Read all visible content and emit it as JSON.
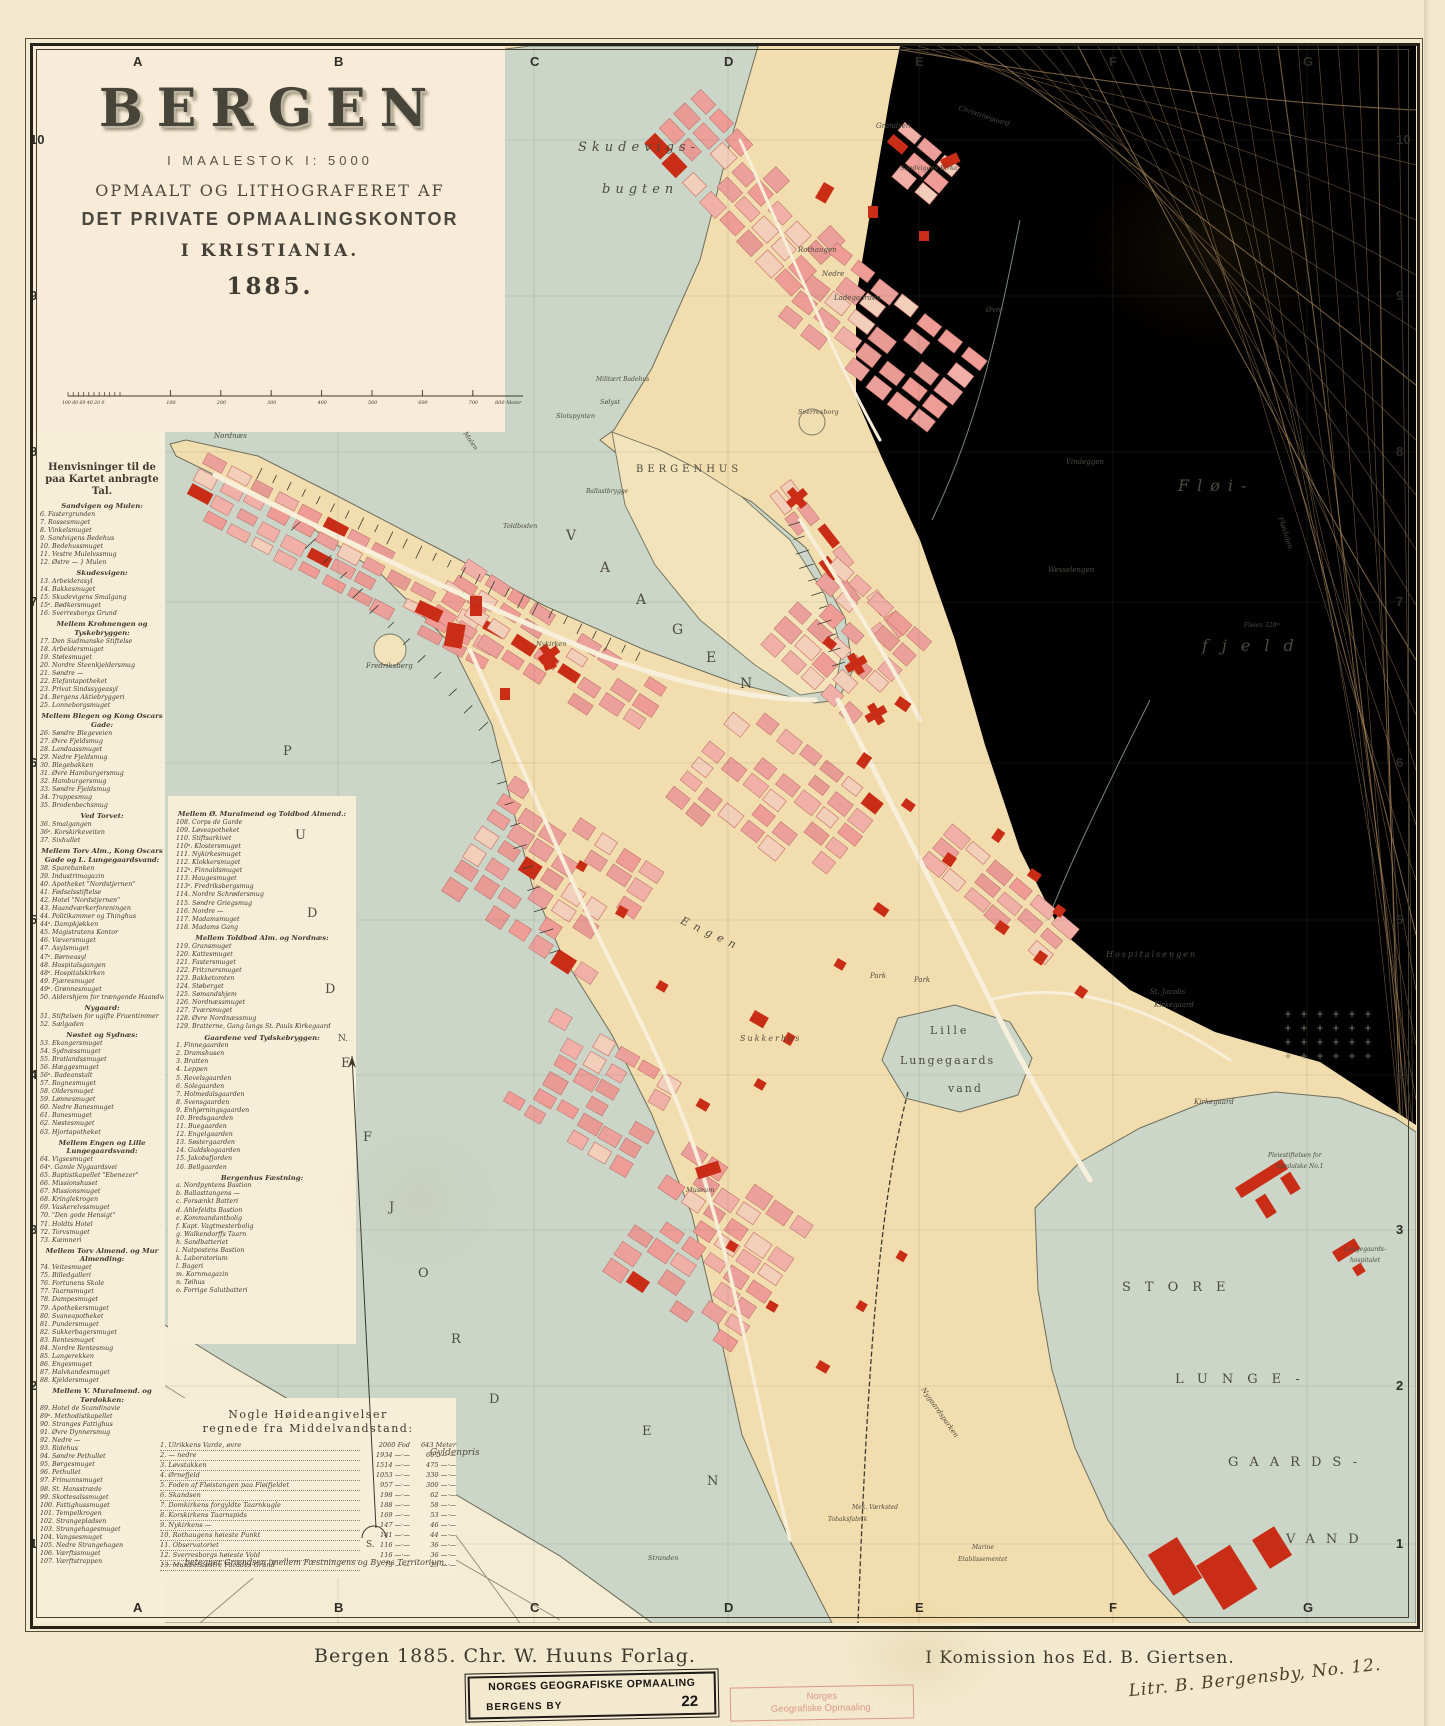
{
  "title": {
    "main": "BERGEN",
    "scale_line": "I MAALESTOK  I: 5000",
    "line2": "OPMAALT OG LITHOGRAFERET AF",
    "line3": "DET PRIVATE OPMAALINGSKONTOR",
    "line4": "I KRISTIANIA.",
    "year": "1885."
  },
  "scale_bar": {
    "sub_labels": "100 80 60 40 20 0",
    "ticks": [
      "100",
      "200",
      "300",
      "400",
      "500",
      "600",
      "700"
    ],
    "end_label": "800 Meter"
  },
  "grid": {
    "columns": [
      "A",
      "B",
      "C",
      "D",
      "E",
      "F",
      "G"
    ],
    "rows": [
      "10",
      "9",
      "8",
      "7",
      "6",
      "5",
      "4",
      "3",
      "2",
      "1"
    ]
  },
  "legend": {
    "title": "Henvisninger til de paa Kartet anbragte Tal.",
    "left_sections": [
      {
        "head": "Sandvigen og Mulen:",
        "items": [
          "6. Fastergrunden",
          "7. Rossesmuget",
          "8. Vinkelsmuget",
          "9. Sandvigens Bedehus",
          "10. Bedehussmuget",
          "11. Vestre Mulelvssmug",
          "12. Østre —  } Mulen"
        ]
      },
      {
        "head": "Skudesvigen:",
        "items": [
          "13. Arbeiderasyl",
          "14. Bakkesmuget",
          "15. Skudevigens Smalgang",
          "15ᵃ. Bødkersmuget",
          "16. Sverresborgs Grund"
        ]
      },
      {
        "head": "Mellem Krohnengen og Tyskebryggen:",
        "items": [
          "17. Den Sudmanske Stiftelse",
          "18. Arbeidersmuget",
          "19. Stølesmuget",
          "20. Nordre Steenkjeldersmug",
          "21. Søndre —",
          "22. Elefantapotheket",
          "23. Privat Sindssygeasyl",
          "24. Bergens Aktiebryggeri",
          "25. Lonneborgsmuget"
        ]
      },
      {
        "head": "Mellem Blegen og Kong Oscars Gade:",
        "items": [
          "26. Søndre Blegeveien",
          "27. Øvre Fjeldsmug",
          "28. Landaassmuget",
          "29. Nedre Fjeldsmug",
          "30. Blegebakken",
          "31. Øvre Hamburgersmug",
          "32. Hamburgersmug",
          "33. Søndre Fjeldsmug",
          "34. Trappesmug",
          "35. Brodenbechsmug"
        ]
      },
      {
        "head": "Ved Torvet:",
        "items": [
          "36. Smalgangen",
          "36ᵃ. Korskirkeveiten",
          "37. Sixhullet"
        ]
      },
      {
        "head": "Mellem Torv Alm., Kong Oscars Gade og L. Lungegaardsvand:",
        "items": [
          "38. Sparebanken",
          "39. Industrimagazin",
          "40. Apotheket \"Nordstjernen\"",
          "41. Fødselsstiftelse",
          "42. Hotel \"Nordstjernen\"",
          "43. Haandværkerforeningen",
          "44. Politikammer og Thinghus",
          "44ᵃ. Dampkjøkken",
          "45. Magistratens Kontor",
          "46. Væversmuget",
          "47. Asylsmuget",
          "47ᵃ. Børneasyl",
          "48. Hospitalsgangen",
          "48ᵃ. Hospitalskirken",
          "49. Fjæresmuget",
          "49ᵃ. Grønnesmuget",
          "50. Aldershjem for trængende Haandværkere"
        ]
      },
      {
        "head": "Nygaard:",
        "items": [
          "51. Stiftelsen for ugifte Fruentimmer",
          "52. Sælgaden"
        ]
      },
      {
        "head": "Nøstet og Sydnæs:",
        "items": [
          "53. Ekangersmuget",
          "54. Sydnæssmuget",
          "55. Bratlandssmuget",
          "56. Hæggesmuget",
          "56ᵃ. Badeanstalt",
          "57. Rognesmuget",
          "58. Oldersmuget",
          "59. Lønnesmuget",
          "60. Nedre Banesmuget",
          "61. Banesmuget",
          "62. Nøstesmuget",
          "63. Hjortapotheket"
        ]
      },
      {
        "head": "Mellem Engen og Lille Lungegaardsvand:",
        "items": [
          "64. Vigsesmuget",
          "64ᵃ. Gamle Nygaardsvei",
          "65. Baptistkapellet \"Ebenezer\"",
          "66. Missionshuset",
          "67. Missionsmuget",
          "68. Kringlekrogen",
          "69. Vaskerelvssmuget",
          "70. \"Den gode Hensigt\"",
          "71. Holdts Hotel",
          "72. Torvsmuget",
          "73. Kæmneri"
        ]
      },
      {
        "head": "Mellem Torv Almend. og Mur Almending:",
        "items": [
          "74. Veitesmuget",
          "75. Billedgalleri",
          "76. Fortunens Skole",
          "77. Taarnsmuget",
          "78. Dampesmuget",
          "79. Apothekersmuget",
          "80. Svaneapotheket",
          "81. Pundersmuget",
          "82. Sukkerbagersmuget",
          "83. Rentesmuget",
          "84. Nordre Rentesmug",
          "85. Langerekken",
          "86. Engesmuget",
          "87. Halvkandesmuget",
          "88. Kjeldersmuget"
        ]
      },
      {
        "head": "Mellem V. Muralmend. og Tørdokken:",
        "items": [
          "89. Hotel de Scandinavie",
          "89ᵃ. Methodistkapellet",
          "90. Stranges Fattighus",
          "91. Øvre Dynnersmug",
          "92. Nedre —",
          "93. Ridehus",
          "94. Søndre Pethullet",
          "95. Børgesmuget",
          "96. Pethullet",
          "97. Frimannsmuget",
          "98. St. Hansstræde",
          "99. Skottesalssmuget",
          "100. Fattighussmuget",
          "101. Tempelkrogen",
          "102. Strangepladsen",
          "103. Strangehagesmuget",
          "104. Vangsesmuget",
          "105. Nedre Strangehagen",
          "106. Værftssmuget",
          "107. Værftstrappen"
        ]
      }
    ],
    "mid_sections": [
      {
        "head": "Mellem Ø. Muralmend og Toldbod Almend.:",
        "items": [
          "108. Corps de Garde",
          "109. Løveapotheket",
          "110. Stiftsarkivet",
          "110ᵃ. Klostersmuget",
          "111. Nykirkesmuget",
          "112. Klokkersmuget",
          "112ᵃ. Finnaldsmuget",
          "113. Haugesmuget",
          "113ᵃ. Fredriksbergsmug",
          "114. Nordre Schrødersmug",
          "115. Søndre Griegsmug",
          "116. Nordre —",
          "117. Madamsmuget",
          "118. Madams Gang"
        ]
      },
      {
        "head": "Mellem Toldbod Alm. og Nordnæs:",
        "items": [
          "119. Gransmuget",
          "120. Kattesmuget",
          "121. Fastersmuget",
          "122. Fritznersmuget",
          "123. Bakketomten",
          "124. Støberget",
          "125. Sømandshjem",
          "126. Nordnæssmuget",
          "127. Tværsmuget",
          "128. Øvre Nordnæssmug",
          "129. Bratterne, Gang langs St. Pauls Kirkegaard"
        ]
      },
      {
        "head": "Gaardene ved Tydskebryggen:",
        "items": [
          "1. Finnegaarden",
          "2. Dramshusen",
          "3. Bratten",
          "4. Leppen",
          "5. Revelsgaarden",
          "6. Solegaarden",
          "7. Holmedalsgaarden",
          "8. Svensgaarden",
          "9. Enhjørningsgaarden",
          "10. Bredsgaarden",
          "11. Buegaarden",
          "12. Engelgaarden",
          "13. Søstergaarden",
          "14. Guldskogaarden",
          "15. Jakobsfjorden",
          "16. Bellgaarden"
        ]
      },
      {
        "head": "Bergenhus Fæstning:",
        "items": [
          "a. Nordpyntens Bastion",
          "b. Ballasttangens —",
          "c. Forsænkt Batteri",
          "d. Ahlefeldts Bastion",
          "e. Kommandantbolig",
          "f. Kapt. Vagtmesterbolig",
          "g. Walkendorffs Taarn",
          "h. Sandbatteriet",
          "i. Natpostens Bastion",
          "k. Laboratorium",
          "l. Bageri",
          "m. Kornmagazin",
          "n. Tøihus",
          "o. Forrige Salutbatteri"
        ]
      }
    ]
  },
  "heights": {
    "title1": "Nogle Høideangivelser",
    "title2": "regnede fra Middelvandstand:",
    "fod_unit": "Fod",
    "meter_unit": "Meter",
    "rows": [
      {
        "n": "1.",
        "name": "Ulrikkens Varde, øvre",
        "fod": "2060",
        "meter": "643"
      },
      {
        "n": "2.",
        "name": "—  nedre",
        "fod": "1934",
        "meter": "607"
      },
      {
        "n": "3.",
        "name": "Løvstakken",
        "fod": "1514",
        "meter": "475"
      },
      {
        "n": "4.",
        "name": "Ørnefjeld",
        "fod": "1053",
        "meter": "330"
      },
      {
        "n": "5.",
        "name": "Foden af Fløistangen paa Fløifjeldet",
        "fod": "957",
        "meter": "300"
      },
      {
        "n": "6.",
        "name": "Skandsen",
        "fod": "198",
        "meter": "62"
      },
      {
        "n": "7.",
        "name": "Domkirkens forgyldte Taarnkugle",
        "fod": "188",
        "meter": "58"
      },
      {
        "n": "8.",
        "name": "Korskirkens Taarnspids",
        "fod": "169",
        "meter": "53"
      },
      {
        "n": "9.",
        "name": "Nykirkens —",
        "fod": "147",
        "meter": "46"
      },
      {
        "n": "10.",
        "name": "Rothaugens høieste Punkt",
        "fod": "141",
        "meter": "44"
      },
      {
        "n": "11.",
        "name": "Observatoriet",
        "fod": "116",
        "meter": "36"
      },
      {
        "n": "12.",
        "name": "Sverresborgs høieste Vold",
        "fod": "116",
        "meter": "36"
      },
      {
        "n": "13.",
        "name": "Musæets østre Facades Grund",
        "fod": "73",
        "meter": "23"
      }
    ]
  },
  "boundary_note": "........  betegner Grændsen imellem Fæstningens og Byens Territorium.",
  "footer": {
    "left": "Bergen 1885.  Chr. W. Huuns  Forlag.",
    "right": "I Komission hos Ed. B. Giertsen.",
    "stamp_black_line1": "NORGES GEOGRAFISKE OPMAALING",
    "stamp_black_line2": "BERGENS BY",
    "stamp_black_number": "22",
    "stamp_red_line1": "Norges",
    "stamp_red_line2": "Geografiske Opmaaling.",
    "signature": "Litr. B. Bergensby, No. 12."
  },
  "colors": {
    "paper": "#f3e9ce",
    "water": "#cbd6c8",
    "land": "#f2ddae",
    "mountain": "#eed19e",
    "block_pink": "#eba09b",
    "building_red": "#c92d16",
    "contour": "#bb9464"
  },
  "labels": [
    {
      "t": "Skudevigs-",
      "x": 578,
      "y": 140,
      "s": 13,
      "l": 5,
      "i": 1
    },
    {
      "t": "bugten",
      "x": 602,
      "y": 182,
      "s": 13,
      "l": 5,
      "i": 1
    },
    {
      "t": "V",
      "x": 566,
      "y": 528,
      "s": 14
    },
    {
      "t": "A",
      "x": 600,
      "y": 560,
      "s": 14
    },
    {
      "t": "A",
      "x": 636,
      "y": 592,
      "s": 14
    },
    {
      "t": "G",
      "x": 672,
      "y": 622,
      "s": 14
    },
    {
      "t": "E",
      "x": 706,
      "y": 650,
      "s": 14
    },
    {
      "t": "N",
      "x": 740,
      "y": 676,
      "s": 14
    },
    {
      "t": "P",
      "x": 283,
      "y": 744,
      "s": 13
    },
    {
      "t": "U",
      "x": 295,
      "y": 828,
      "s": 13
    },
    {
      "t": "D",
      "x": 307,
      "y": 906,
      "s": 13
    },
    {
      "t": "D",
      "x": 325,
      "y": 982,
      "s": 13
    },
    {
      "t": "E",
      "x": 341,
      "y": 1056,
      "s": 13
    },
    {
      "t": "F",
      "x": 363,
      "y": 1130,
      "s": 13
    },
    {
      "t": "J",
      "x": 389,
      "y": 1200,
      "s": 13
    },
    {
      "t": "O",
      "x": 418,
      "y": 1266,
      "s": 13
    },
    {
      "t": "R",
      "x": 451,
      "y": 1332,
      "s": 13
    },
    {
      "t": "D",
      "x": 489,
      "y": 1392,
      "s": 13
    },
    {
      "t": "E",
      "x": 642,
      "y": 1424,
      "s": 13
    },
    {
      "t": "N",
      "x": 707,
      "y": 1474,
      "s": 13
    },
    {
      "t": "STORE",
      "x": 1122,
      "y": 1280,
      "s": 13,
      "l": 14
    },
    {
      "t": "LUNGE-",
      "x": 1175,
      "y": 1372,
      "s": 13,
      "l": 14
    },
    {
      "t": "GAARDS-",
      "x": 1228,
      "y": 1455,
      "s": 13,
      "l": 11
    },
    {
      "t": "VAND",
      "x": 1286,
      "y": 1532,
      "s": 13,
      "l": 11
    },
    {
      "t": "Lille",
      "x": 930,
      "y": 1024,
      "s": 11,
      "l": 3
    },
    {
      "t": "Lungegaards",
      "x": 900,
      "y": 1054,
      "s": 11,
      "l": 2
    },
    {
      "t": "vand",
      "x": 948,
      "y": 1082,
      "s": 11,
      "l": 2
    },
    {
      "t": "BERGENHUS",
      "x": 636,
      "y": 464,
      "s": 10,
      "l": 4
    },
    {
      "t": "Fløi-",
      "x": 1178,
      "y": 476,
      "s": 16,
      "l": 8,
      "i": 1
    },
    {
      "t": "fjeld",
      "x": 1202,
      "y": 636,
      "s": 16,
      "l": 14,
      "i": 1
    },
    {
      "t": "Fløidalen",
      "x": 1284,
      "y": 516,
      "s": 7,
      "i": 1,
      "r": 72
    },
    {
      "t": "Fløien 320ᵐ",
      "x": 1244,
      "y": 622,
      "s": 6,
      "i": 1
    },
    {
      "t": "Vindeggen",
      "x": 1066,
      "y": 458,
      "s": 7,
      "i": 1
    },
    {
      "t": "Wesselengen",
      "x": 1048,
      "y": 566,
      "s": 7,
      "i": 1
    },
    {
      "t": "Rothaugen",
      "x": 798,
      "y": 246,
      "s": 7,
      "i": 1
    },
    {
      "t": "Nedre",
      "x": 822,
      "y": 270,
      "s": 7,
      "i": 1
    },
    {
      "t": "Ladegaarden",
      "x": 834,
      "y": 294,
      "s": 7,
      "i": 1
    },
    {
      "t": "Øvre",
      "x": 986,
      "y": 306,
      "s": 7,
      "i": 1
    },
    {
      "t": "Grandsen",
      "x": 876,
      "y": 122,
      "s": 7,
      "i": 1
    },
    {
      "t": "Christinegaard",
      "x": 960,
      "y": 104,
      "s": 7,
      "i": 1,
      "r": 18
    },
    {
      "t": "Sandvigens Kirke",
      "x": 900,
      "y": 164,
      "s": 6.5,
      "i": 1
    },
    {
      "t": "Sverresborg",
      "x": 798,
      "y": 408,
      "s": 6.5,
      "i": 1
    },
    {
      "t": "Slotspynten",
      "x": 556,
      "y": 412,
      "s": 6.5,
      "i": 1
    },
    {
      "t": "Sølyst",
      "x": 600,
      "y": 398,
      "s": 6.5,
      "i": 1
    },
    {
      "t": "Militært Badehus",
      "x": 596,
      "y": 376,
      "s": 6,
      "i": 1
    },
    {
      "t": "Ballastbrygge",
      "x": 586,
      "y": 488,
      "s": 6,
      "i": 1
    },
    {
      "t": "Molen",
      "x": 468,
      "y": 430,
      "s": 6.5,
      "i": 1,
      "r": 55
    },
    {
      "t": "Toldboden",
      "x": 503,
      "y": 522,
      "s": 6.5,
      "i": 1
    },
    {
      "t": "Nykirken",
      "x": 536,
      "y": 640,
      "s": 6.5,
      "i": 1
    },
    {
      "t": "Fredriksberg",
      "x": 366,
      "y": 662,
      "s": 7,
      "i": 1
    },
    {
      "t": "Nordnæs",
      "x": 214,
      "y": 432,
      "s": 7,
      "i": 1
    },
    {
      "t": "Engen",
      "x": 684,
      "y": 914,
      "s": 11,
      "l": 6,
      "i": 1,
      "r": 25
    },
    {
      "t": "Sukkerhus",
      "x": 740,
      "y": 1034,
      "s": 8,
      "l": 2,
      "i": 1
    },
    {
      "t": "Museum",
      "x": 686,
      "y": 1186,
      "s": 6.5,
      "i": 1
    },
    {
      "t": "Park",
      "x": 870,
      "y": 972,
      "s": 7,
      "i": 1
    },
    {
      "t": "Park",
      "x": 914,
      "y": 976,
      "s": 7,
      "i": 1
    },
    {
      "t": "Hospitalsengen",
      "x": 1106,
      "y": 950,
      "s": 8,
      "l": 2,
      "i": 1
    },
    {
      "t": "St. Jacobs",
      "x": 1150,
      "y": 988,
      "s": 7,
      "i": 1
    },
    {
      "t": "Kirkegaard",
      "x": 1154,
      "y": 1001,
      "s": 7,
      "i": 1
    },
    {
      "t": "Kirkegaard",
      "x": 1194,
      "y": 1098,
      "s": 7,
      "i": 1
    },
    {
      "t": "Pleiestiftelsen for",
      "x": 1268,
      "y": 1152,
      "s": 6,
      "i": 1
    },
    {
      "t": "Spedalske No.1",
      "x": 1276,
      "y": 1163,
      "s": 6,
      "i": 1
    },
    {
      "t": "Lungegaards-",
      "x": 1344,
      "y": 1246,
      "s": 6,
      "i": 1
    },
    {
      "t": "hospitalet",
      "x": 1350,
      "y": 1257,
      "s": 6,
      "i": 1
    },
    {
      "t": "Nygaardsparken",
      "x": 926,
      "y": 1386,
      "s": 7,
      "i": 1,
      "r": 55
    },
    {
      "t": "Gyldenpris",
      "x": 430,
      "y": 1448,
      "s": 9,
      "i": 1
    },
    {
      "t": "Stranden",
      "x": 648,
      "y": 1554,
      "s": 6.5,
      "i": 1
    },
    {
      "t": "Mek. Værksted",
      "x": 852,
      "y": 1504,
      "s": 6,
      "i": 1
    },
    {
      "t": "Tobaksfabrik",
      "x": 828,
      "y": 1516,
      "s": 6,
      "i": 1
    },
    {
      "t": "Marine",
      "x": 972,
      "y": 1544,
      "s": 6,
      "i": 1
    },
    {
      "t": "Etablissementet",
      "x": 958,
      "y": 1556,
      "s": 6,
      "i": 1
    },
    {
      "t": "N.",
      "x": 338,
      "y": 1034,
      "s": 9
    },
    {
      "t": "S.",
      "x": 366,
      "y": 1540,
      "s": 9
    }
  ]
}
